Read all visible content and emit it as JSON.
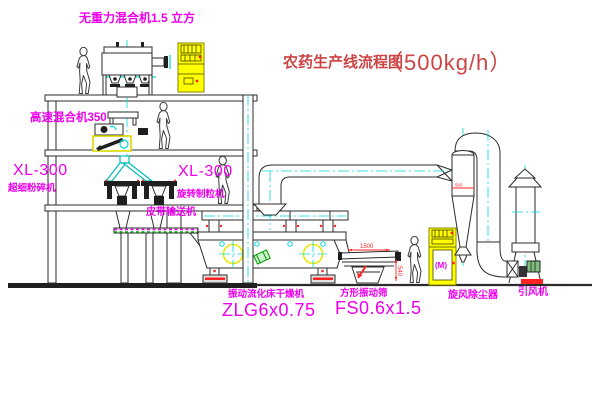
{
  "title": {
    "main": "农药生产线流程图",
    "capacity": "（500kg/h）"
  },
  "labels": {
    "gravity_mixer": "无重力混合机1.5 立方",
    "high_speed_mixer": "高速混合机350",
    "mill_model": "XL-300",
    "mill_name": "超细粉碎机",
    "granulator_model": "XL-300",
    "granulator_name": "旋转制粒机",
    "belt_conveyor": "皮带输送机",
    "dryer_name": "振动流化床干燥机",
    "dryer_model": "ZLG6x0.75",
    "screen_name": "方形振动筛",
    "screen_model": "FS0.6x1.5",
    "cyclone_name": "旋风除尘器",
    "fan_name": "引风机"
  },
  "annotations": {
    "screen_length_dim": "1500",
    "screen_height_dim": "540",
    "cyclone_dim": "500",
    "motor_symbol": "(M)"
  },
  "colors": {
    "label_magenta": "#ee00ee",
    "title_red": "#cc4444",
    "annotation_red": "#ff2222",
    "centerline_cyan": "#00d9d9",
    "equipment_yellow": "#ffff00",
    "belt_green": "#00aa00",
    "line_dark": "#2b2b2b",
    "background": "#ffffff"
  }
}
